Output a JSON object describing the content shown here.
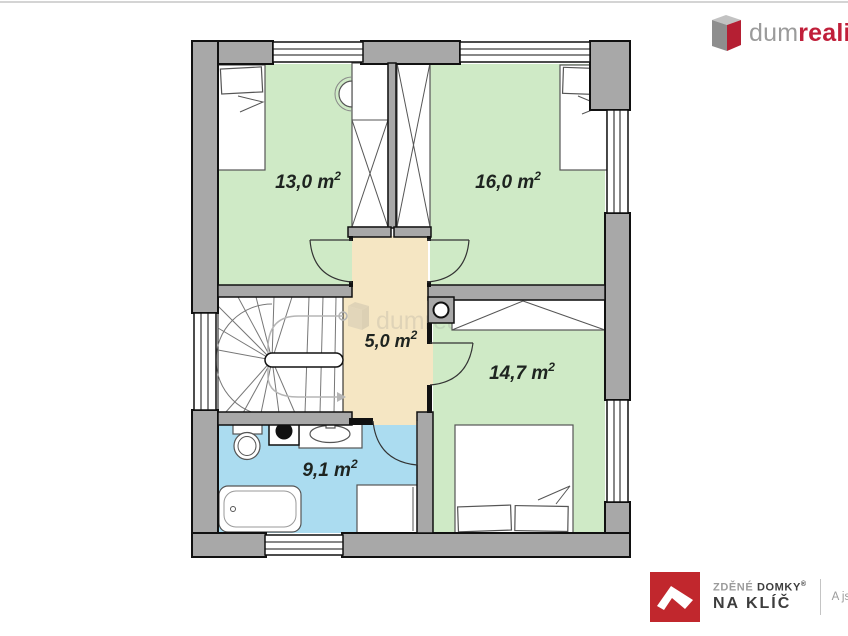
{
  "floorplan": {
    "rooms": [
      {
        "id": "bedroom-top-left",
        "area": "13,0 m",
        "sup": "2"
      },
      {
        "id": "bedroom-top-right",
        "area": "16,0 m",
        "sup": "2"
      },
      {
        "id": "hall",
        "area": "5,0 m",
        "sup": "2"
      },
      {
        "id": "bedroom-bottom-right",
        "area": "14,7 m",
        "sup": "2"
      },
      {
        "id": "bathroom",
        "area": "9,1 m",
        "sup": "2"
      }
    ],
    "watermark": "dumrealit.cz",
    "colors": {
      "room_green": "#cfeac6",
      "hall_beige": "#f5e6c3",
      "bath_blue": "#abdcf0",
      "wall_gray": "#a8a8a8",
      "brand_red": "#c01f3a",
      "footer_red": "#c1272d"
    }
  },
  "brand_top": {
    "prefix_gray": "dum",
    "accent_bold": "realit",
    "suffix": ".cz"
  },
  "brand_bottom": {
    "line1_light": "ZDĚNÉ",
    "line1_dark": "DOMKY",
    "registered": "®",
    "line2_light": "NA",
    "line2_dark": "KLÍČ",
    "tagline": "A jste doma"
  }
}
